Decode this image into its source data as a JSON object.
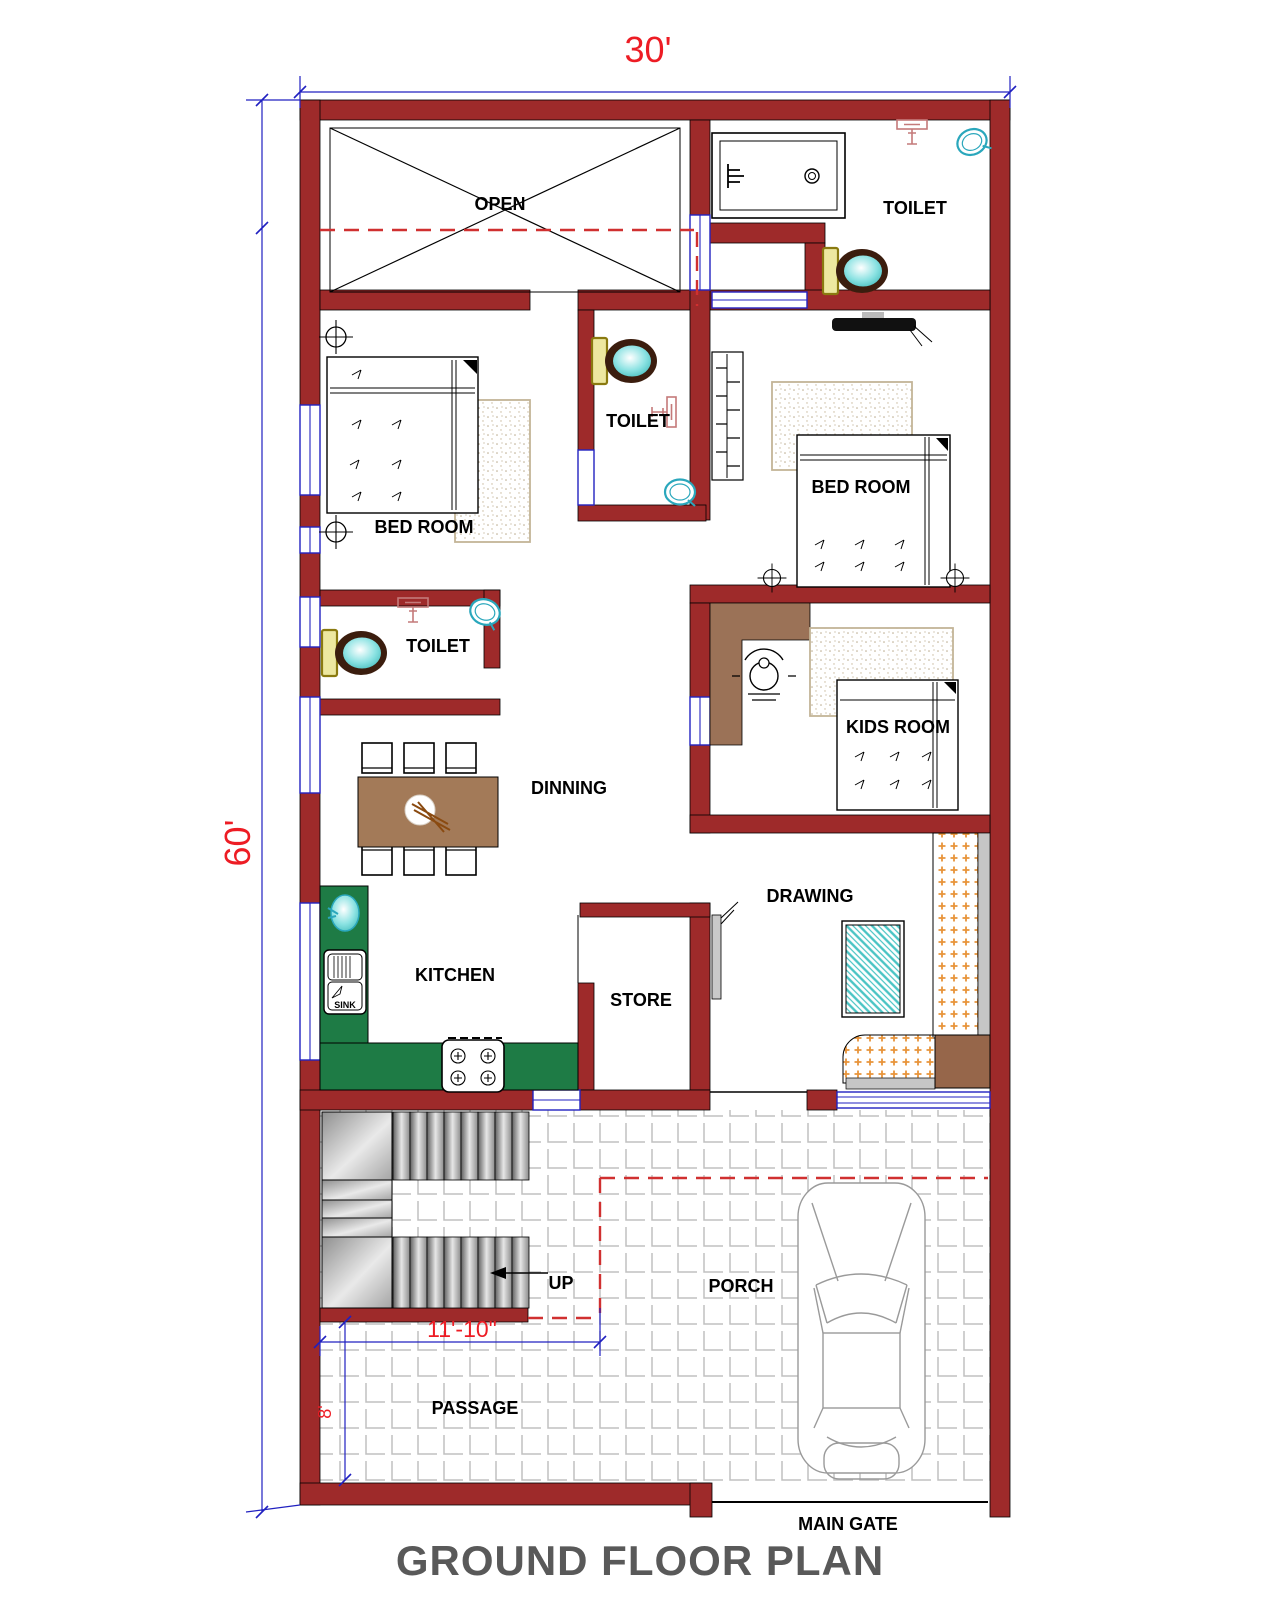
{
  "title": "GROUND FLOOR PLAN",
  "dimensions": {
    "plot_width": "30'",
    "plot_height": "60'",
    "stair_hall_width": "11'-10\"",
    "passage_width": "8'"
  },
  "labels": {
    "open": "OPEN",
    "toilet_top_right": "TOILET",
    "bed_room_left": "BED ROOM",
    "toilet_middle": "TOILET",
    "bed_room_right": "BED ROOM",
    "toilet_left": "TOILET",
    "dinning": "DINNING",
    "kids_room": "KIDS ROOM",
    "drawing": "DRAWING",
    "kitchen": "KITCHEN",
    "store": "STORE",
    "up": "UP",
    "porch": "PORCH",
    "passage": "PASSAGE",
    "main_gate": "MAIN GATE",
    "sink": "SINK"
  },
  "colors": {
    "wall": "#9e2a2a",
    "window_frame": "#2222c0",
    "dimension_line": "#2020c0",
    "dimension_text": "#ed1c24",
    "dashed_line": "#d03030",
    "title_text": "#595959",
    "kitchen_counter": "#1e7b45",
    "dining_table": "#a37a58",
    "kids_desk": "#9b7257",
    "sofa_accent": "#e8943a",
    "corner_table": "#96664a",
    "tank_yellow": "#ede8a0",
    "fixture_teal": "#49c4c4",
    "tile_line": "#c0c0c0"
  }
}
